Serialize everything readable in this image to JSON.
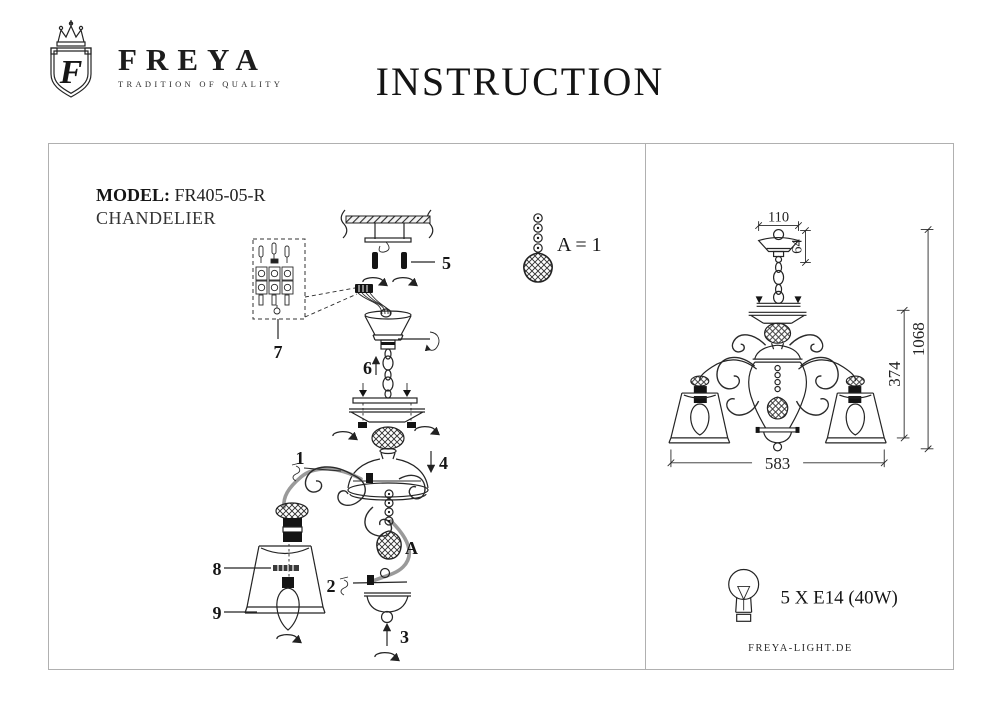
{
  "header": {
    "brand": "FREYA",
    "tagline": "TRADITION OF QUALITY",
    "logo_letter": "F",
    "title": "INSTRUCTION"
  },
  "left_panel": {
    "model_label": "MODEL:",
    "model_value": "FR405-05-R",
    "product_type": "CHANDELIER",
    "crystal_note": "A = 1",
    "crystal_label": "A",
    "parts": {
      "p1": "1",
      "p2": "2",
      "p3": "3",
      "p4": "4",
      "p5": "5",
      "p6": "6",
      "p7": "7",
      "p8": "8",
      "p9": "9"
    }
  },
  "right_panel": {
    "dims": {
      "canopy_width": "110",
      "canopy_height": "64",
      "body_height": "374",
      "total_height": "1068",
      "fixture_width": "583"
    },
    "bulb_spec": "5 X E14 (40W)",
    "website": "FREYA-LIGHT.DE"
  },
  "colors": {
    "ink": "#1c1c1c",
    "line": "#2a2a2a",
    "border": "#b0b0b0",
    "tube_gray": "#9a9a9a"
  }
}
